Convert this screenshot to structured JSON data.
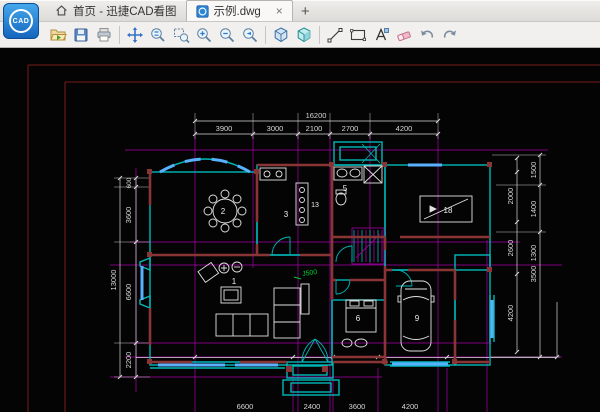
{
  "logo": {
    "text": "CAD"
  },
  "tabs": {
    "home": {
      "label": "首页 - 迅捷CAD看图"
    },
    "doc": {
      "label": "示例.dwg",
      "close": "×"
    },
    "new_tab": "+"
  },
  "toolbar": {
    "items": [
      "open-file",
      "save",
      "print",
      "pan",
      "zoom-realtime",
      "zoom-window",
      "zoom-in",
      "zoom-out",
      "zoom-previous",
      "view-3d-wireframe",
      "view-3d-shaded",
      "draw-line",
      "draw-rectangle",
      "add-text",
      "eraser",
      "undo",
      "redo"
    ]
  },
  "canvas": {
    "colors": {
      "background": "#040404",
      "frame": "#7a1c1c",
      "axis": "#a800a8",
      "walls": "#00b8b8",
      "inner_walls": "#8a3535",
      "windows": "#59b0ff",
      "dimension_text": "#d8d8d8",
      "annotation": "#00cc33"
    },
    "dims": {
      "top_total": "16200",
      "top_segments": [
        "3900",
        "3000",
        "2100",
        "2700",
        "4200"
      ],
      "left_total": "13000",
      "left_segments": [
        "600",
        "3600",
        "6600",
        "2200"
      ],
      "right_inner_segments": [
        "2000",
        "2600",
        "4200"
      ],
      "right_outer_segments": [
        "1500",
        "1400",
        "1300",
        "3500"
      ],
      "bottom_segments": [
        "6600",
        "2400",
        "3600",
        "4200"
      ]
    },
    "rooms": {
      "r1": "1",
      "r2": "2",
      "r3": "3",
      "r5": "5",
      "r6": "6",
      "r9": "9",
      "r13": "13",
      "r18": "18"
    },
    "annotation": "J500"
  }
}
